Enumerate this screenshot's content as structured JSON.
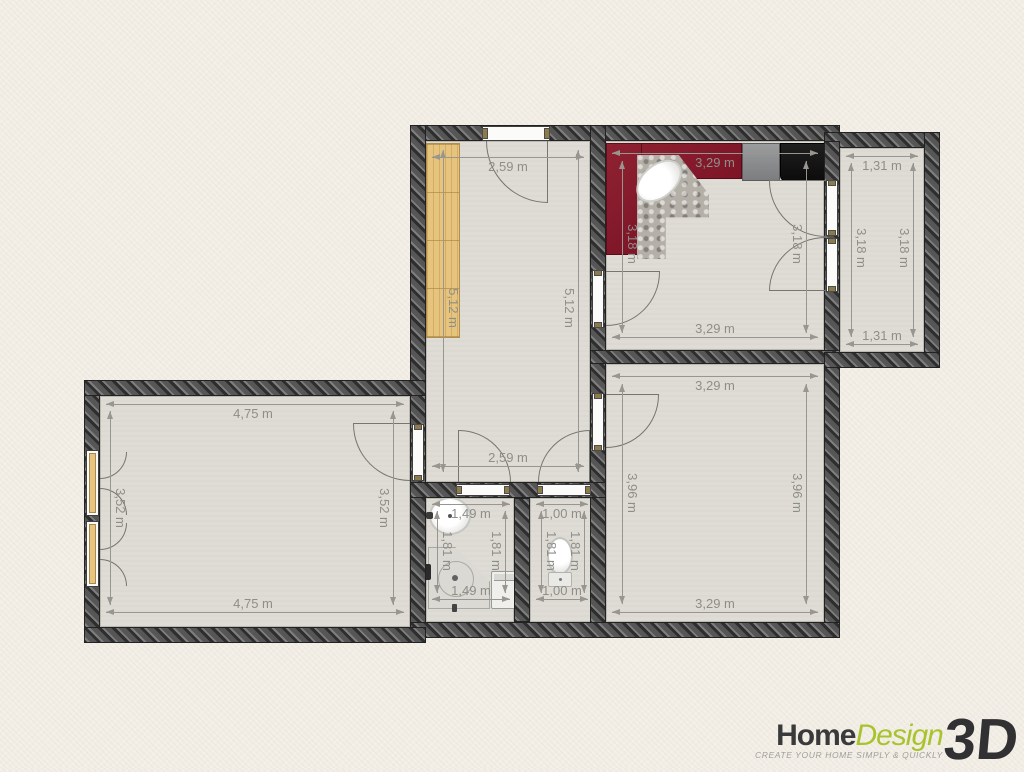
{
  "brand": {
    "name_part1": "Home",
    "name_part2": "Design",
    "name_part3": "3D",
    "tagline": "CREATE YOUR HOME SIMPLY & QUICKLY"
  },
  "dims": {
    "hall": {
      "top": "2,59 m",
      "bottom": "2,59 m",
      "left": "5,12 m",
      "right": "5,12 m"
    },
    "kitchen": {
      "top": "3,29 m",
      "bottom": "3,29 m",
      "left": "3,18 m",
      "right": "3,18 m"
    },
    "pantry": {
      "top": "1,31 m",
      "bottom": "1,31 m",
      "left": "3,18 m",
      "right": "3,18 m"
    },
    "bedroom": {
      "top": "3,29 m",
      "bottom": "3,29 m",
      "left": "3,96 m",
      "right": "3,96 m"
    },
    "living": {
      "top": "4,75 m",
      "bottom": "4,75 m",
      "left": "3,52 m",
      "right": "3,52 m"
    },
    "bathroom": {
      "top": "1,49 m",
      "bottom": "1,49 m",
      "left": "1,81 m",
      "right": "1,81 m"
    },
    "wc": {
      "top": "1,00 m",
      "bottom": "1,00 m",
      "left": "1,81 m",
      "right": "1,81 m"
    }
  },
  "colors": {
    "background": "#f2eee5",
    "wall": "#5c5c5c",
    "floor": "#dfdcd5",
    "kitchen_counter": "#84192a",
    "wood": "#e8c57e",
    "dimension_text": "#8e8e89",
    "brand_green": "#a9c32f",
    "brand_dark": "#3a3a3c"
  }
}
